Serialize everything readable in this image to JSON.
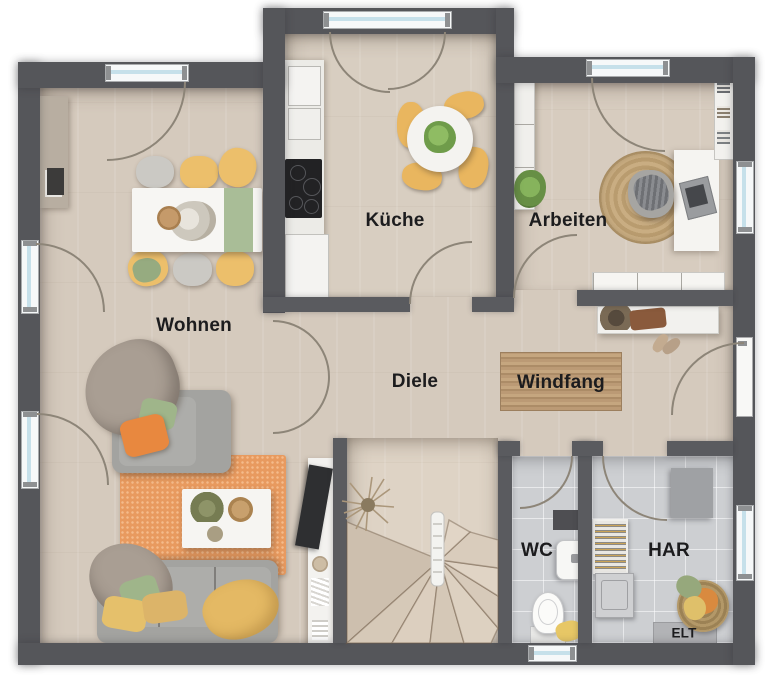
{
  "rooms": [
    {
      "id": "kueche",
      "label": "Küche"
    },
    {
      "id": "arbeiten",
      "label": "Arbeiten"
    },
    {
      "id": "wohnen",
      "label": "Wohnen"
    },
    {
      "id": "diele",
      "label": "Diele"
    },
    {
      "id": "windfang",
      "label": "Windfang"
    },
    {
      "id": "wc",
      "label": "WC"
    },
    {
      "id": "har",
      "label": "HAR"
    },
    {
      "id": "elt",
      "label": "ELT"
    }
  ],
  "colors": {
    "wall": "#55565a",
    "floor_wood": "#d5cabd",
    "floor_tile": "#cdcfd2",
    "window_glass": "#c6e0ea",
    "accent_orange_rug": "#e89a5f",
    "accent_orange_cushion": "#e8883f",
    "accent_yellow": "#ecbf6b",
    "accent_green": "#9fb58a",
    "jute": "#c3a478",
    "label_text": "#1c1c1e"
  }
}
